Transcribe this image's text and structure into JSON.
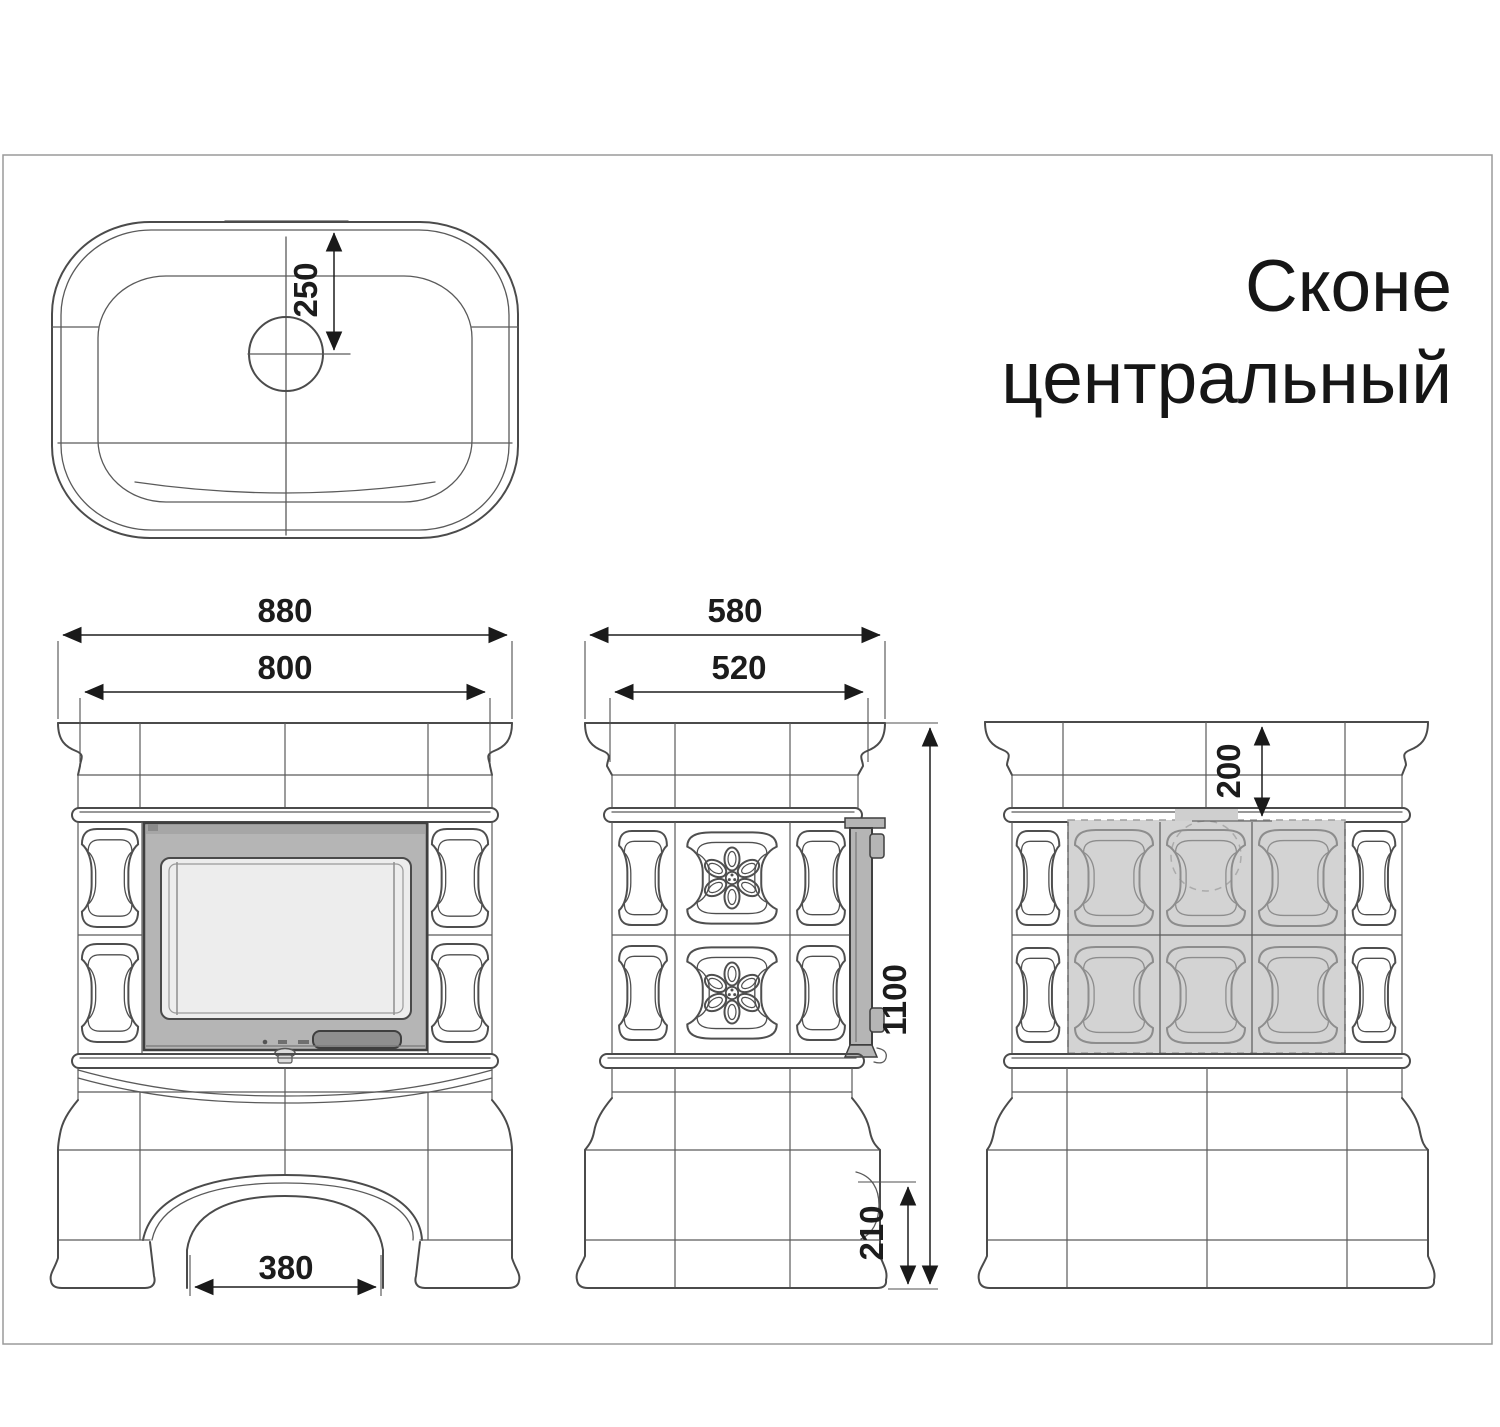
{
  "title": {
    "line1": "Сконе",
    "line2": "центральный"
  },
  "dimensions": {
    "plan_chimney_offset": "250",
    "front_overall_width": "880",
    "front_body_width": "800",
    "front_arch_width": "380",
    "side_overall_depth": "580",
    "side_body_depth": "520",
    "side_overall_height": "1100",
    "side_base_detail_height": "210",
    "rear_top_offset": "200"
  },
  "colors": {
    "outline": "#4b4b4b",
    "door_frame": "#b5b5b5",
    "door_top_band": "#a6a6a6",
    "door_glass": "#ededed",
    "door_handle": "#8f8f8f",
    "knob": "#dcdcdc",
    "rear_shaded_area": "#d3d3d3",
    "rear_chimney_tab": "#cfcfcf"
  }
}
